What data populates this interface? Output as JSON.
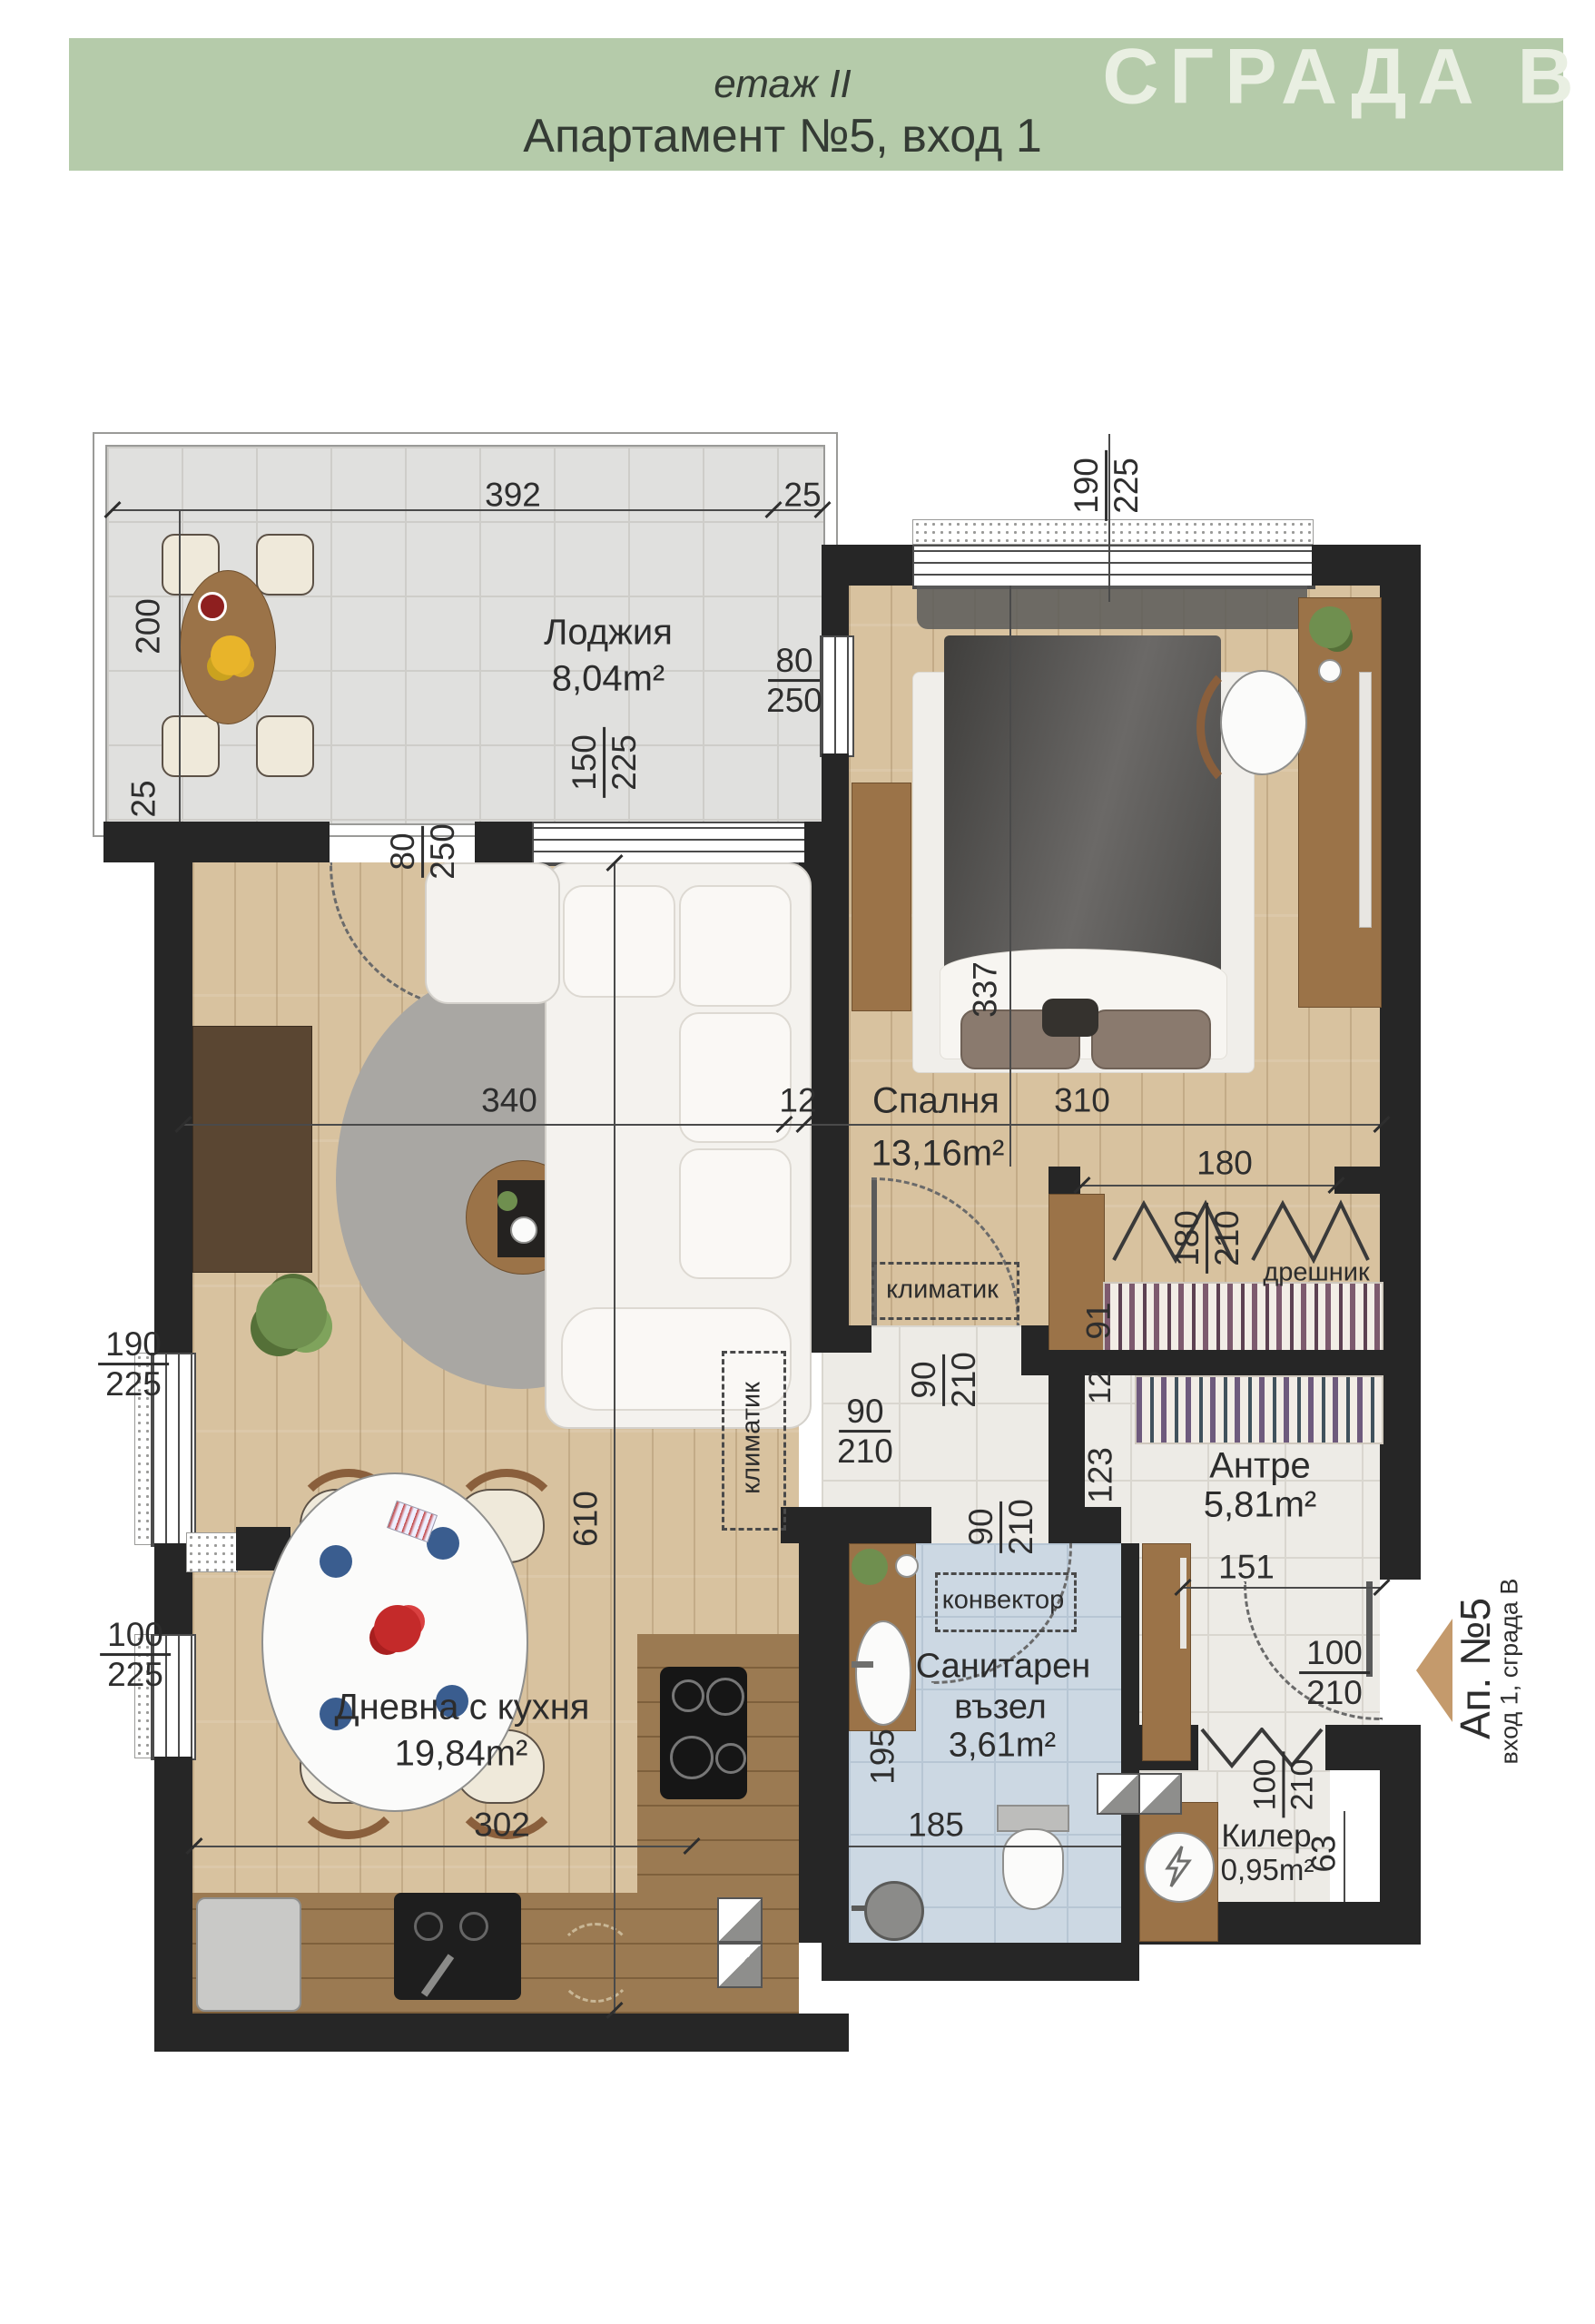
{
  "header": {
    "floor_label": "етаж II",
    "apartment_title": "Апартамент №5, вход 1",
    "building_label": "СГРАДА В"
  },
  "rooms": {
    "loggia": {
      "name": "Лоджия",
      "area": "8,04m²"
    },
    "bedroom": {
      "name": "Спалня",
      "area": "13,16m²"
    },
    "living": {
      "name": "Дневна с кухня",
      "area": "19,84m²"
    },
    "hall": {
      "name": "Антре",
      "area": "5,81m²"
    },
    "bathroom": {
      "name_line1": "Санитарен",
      "name_line2": "възел",
      "area": "3,61m²"
    },
    "storage": {
      "name": "Килер",
      "area": "0,95m²"
    },
    "wardrobe_label": "дрешник"
  },
  "equipment": {
    "ac_bedroom": "климатик",
    "ac_living": "климатик",
    "convector": "конвектор"
  },
  "entry": {
    "apartment": "Ап. №5",
    "entrance": "вход 1, сграда В"
  },
  "dimensions": {
    "loggia_width": "392",
    "loggia_side": "25",
    "loggia_height": "200",
    "loggia_corner": "25",
    "bedroom_window": {
      "a": "190",
      "b": "225"
    },
    "bedroom_balcony": {
      "a": "80",
      "b": "250"
    },
    "loggia_window": {
      "a": "150",
      "b": "225"
    },
    "living_door": {
      "a": "80",
      "b": "250"
    },
    "bedroom_depth": "337",
    "living_width": "340",
    "wall_gap": "12",
    "bedroom_width": "310",
    "wardrobe_width": "180",
    "wardrobe_door": {
      "a": "180",
      "b": "210"
    },
    "wardrobe_depth": "91",
    "living_depth": "610",
    "bedroom_door": {
      "a": "90",
      "b": "210"
    },
    "corridor_gap": "12",
    "corridor_len": "123",
    "living_pass": {
      "a": "90",
      "b": "210"
    },
    "bath_door": {
      "a": "90",
      "b": "210"
    },
    "hall_width": "151",
    "window_living": {
      "a": "190",
      "b": "225"
    },
    "window_kitchen": {
      "a": "100",
      "b": "225"
    },
    "entry_door": {
      "a": "100",
      "b": "210"
    },
    "storage_door": {
      "a": "100",
      "b": "210"
    },
    "storage_side": "63",
    "bath_depth": "195",
    "bath_width": "185",
    "kitchen_width": "302"
  },
  "colors": {
    "header_band": "#b5cbaa",
    "building_text": "#e9efe2",
    "wall": "#262626",
    "wood_floor": "#d8c29f",
    "counter_wood": "#9b7a52",
    "loggia_tile": "#e0e0de",
    "bath_tile": "#ccd8e3",
    "marble": "#edebe6",
    "entry_arrow": "#c49a6c",
    "dim_text": "#2e2e2e"
  }
}
